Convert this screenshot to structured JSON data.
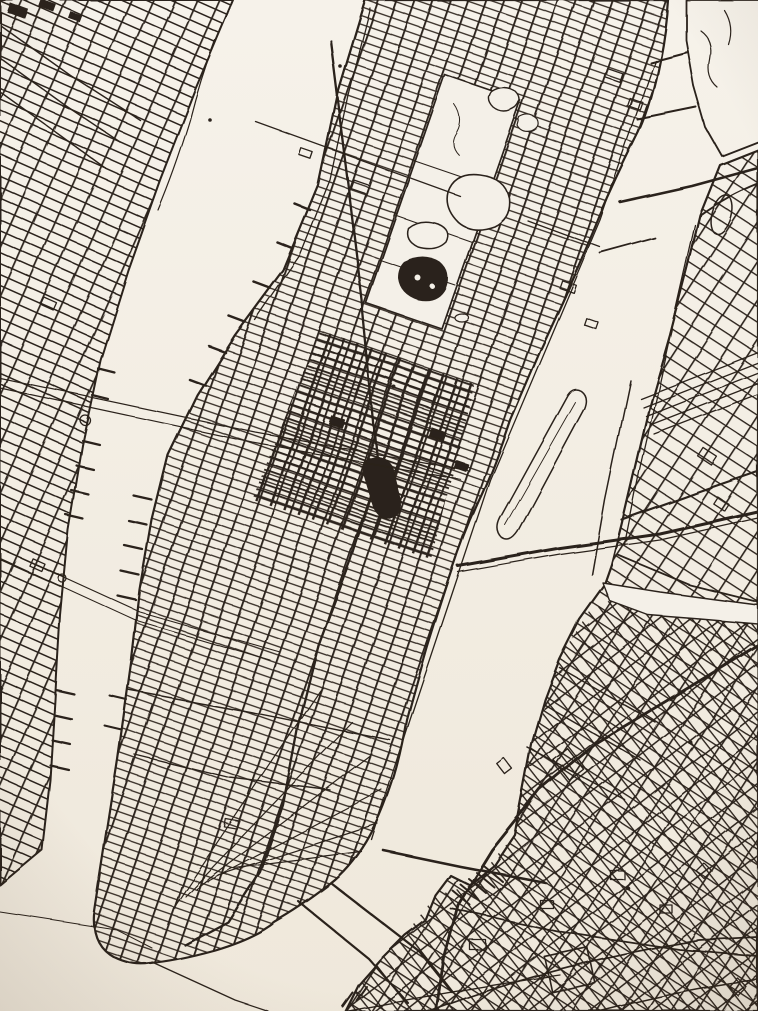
{
  "page": {
    "title": "Hand-drawn black ink street map of New York City on off-white paper",
    "note": "Unlabeled pen-and-ink map print; image contains no visible text"
  },
  "colors": {
    "ink": "#2a211a",
    "paper_top": "#f6f2ea",
    "paper_bottom": "#efe8db",
    "water": "#f4f0e8"
  },
  "map": {
    "city": "New York City",
    "style": "pen-and-ink line drawing, streets only, no labels",
    "orientation": "rotated so Manhattan island runs from top edge down toward bottom-left tip",
    "regions": [
      {
        "name": "new-jersey-waterfront",
        "desc": "Hoboken / Jersey City street grid, left edge"
      },
      {
        "name": "manhattan",
        "desc": "central island with dense tilted street grid"
      },
      {
        "name": "queens-long-island-city",
        "desc": "upper right landmass grid"
      },
      {
        "name": "brooklyn",
        "desc": "lower right landmass, sparser organic streets"
      },
      {
        "name": "randalls-island",
        "desc": "top right island blob"
      },
      {
        "name": "roosevelt-island",
        "desc": "narrow sliver in the East River"
      }
    ],
    "water": [
      "hudson-river",
      "east-river",
      "harlem-river",
      "newtown-creek",
      "upper-new-york-bay",
      "wallabout-bay"
    ],
    "bridges": [
      "queensboro-bridge",
      "williamsburg-bridge",
      "manhattan-bridge",
      "brooklyn-bridge",
      "triborough-bridge",
      "harlem-river-bridges",
      "hell-gate-approach"
    ],
    "tunnels": [
      "lincoln-tunnel",
      "holland-tunnel",
      "brooklyn-battery-tunnel",
      "path-tubes"
    ],
    "landmarks": [
      "central-park",
      "central-park-reservoir",
      "central-park-lake",
      "harlem-meer-ponds",
      "the-ramble",
      "midtown-dense-grid",
      "times-square-ink-blot",
      "broadway-diagonal",
      "crosstown-125th-line",
      "west-side-piers",
      "chelsea-piers",
      "hoboken-piers",
      "jersey-city-piers",
      "brooklyn-navy-yard-docks",
      "sunnyside-rail-yard",
      "nj-rail-yard"
    ],
    "text_labels_visible": false
  }
}
